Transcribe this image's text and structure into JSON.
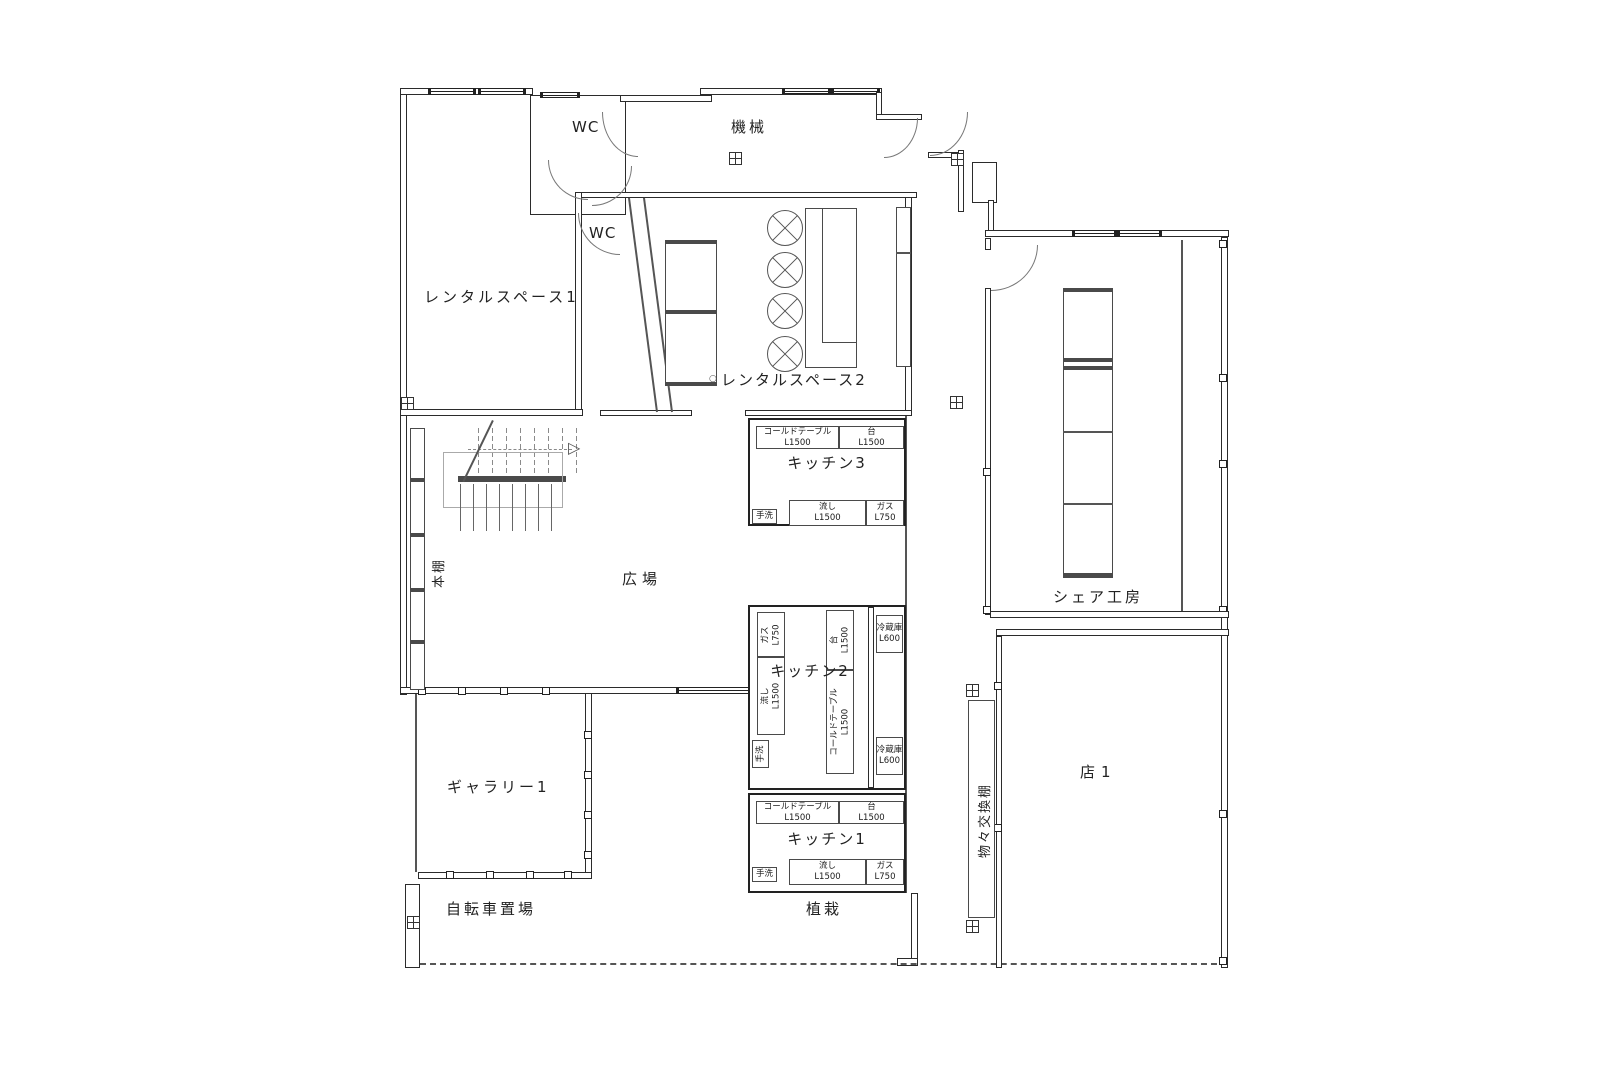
{
  "rooms": {
    "wc_upper": "WC",
    "machinery": "機械",
    "wc_lower": "WC",
    "rental_space_1": "レンタルスペース1",
    "rental_space_2": "レンタルスペース2",
    "plaza": "広場",
    "bookshelf": "本棚",
    "gallery_1": "ギャラリー1",
    "bicycle_parking": "自転車置場",
    "planting": "植栽",
    "barter_shelf": "物々交換棚",
    "share_workshop": "シェア工房",
    "shop_1": "店1"
  },
  "icons": {
    "stairs_arrow": "▷",
    "rental2_marker": "○"
  },
  "kitchen3": {
    "title": "キッチン3",
    "cold_table": {
      "label": "コールドテーブル",
      "size": "L1500"
    },
    "counter": {
      "label": "台",
      "size": "L1500"
    },
    "handwash": "手洗",
    "sink": {
      "label": "流し",
      "size": "L1500"
    },
    "gas": {
      "label": "ガス",
      "size": "L750"
    }
  },
  "kitchen2": {
    "title": "キッチン2",
    "gas": {
      "label": "ガス",
      "size": "L750"
    },
    "sink": {
      "label": "流し",
      "size": "L1500"
    },
    "handwash": "手洗",
    "counter": {
      "label": "台",
      "size": "L1500"
    },
    "cold_table": {
      "label": "コールドテーブル",
      "size": "L1500"
    },
    "fridge_top": {
      "label": "冷蔵庫",
      "size": "L600"
    },
    "fridge_bottom": {
      "label": "冷蔵庫",
      "size": "L600"
    }
  },
  "kitchen1": {
    "title": "キッチン1",
    "cold_table": {
      "label": "コールドテーブル",
      "size": "L1500"
    },
    "counter": {
      "label": "台",
      "size": "L1500"
    },
    "handwash": "手洗",
    "sink": {
      "label": "流し",
      "size": "L1500"
    },
    "gas": {
      "label": "ガス",
      "size": "L750"
    }
  }
}
